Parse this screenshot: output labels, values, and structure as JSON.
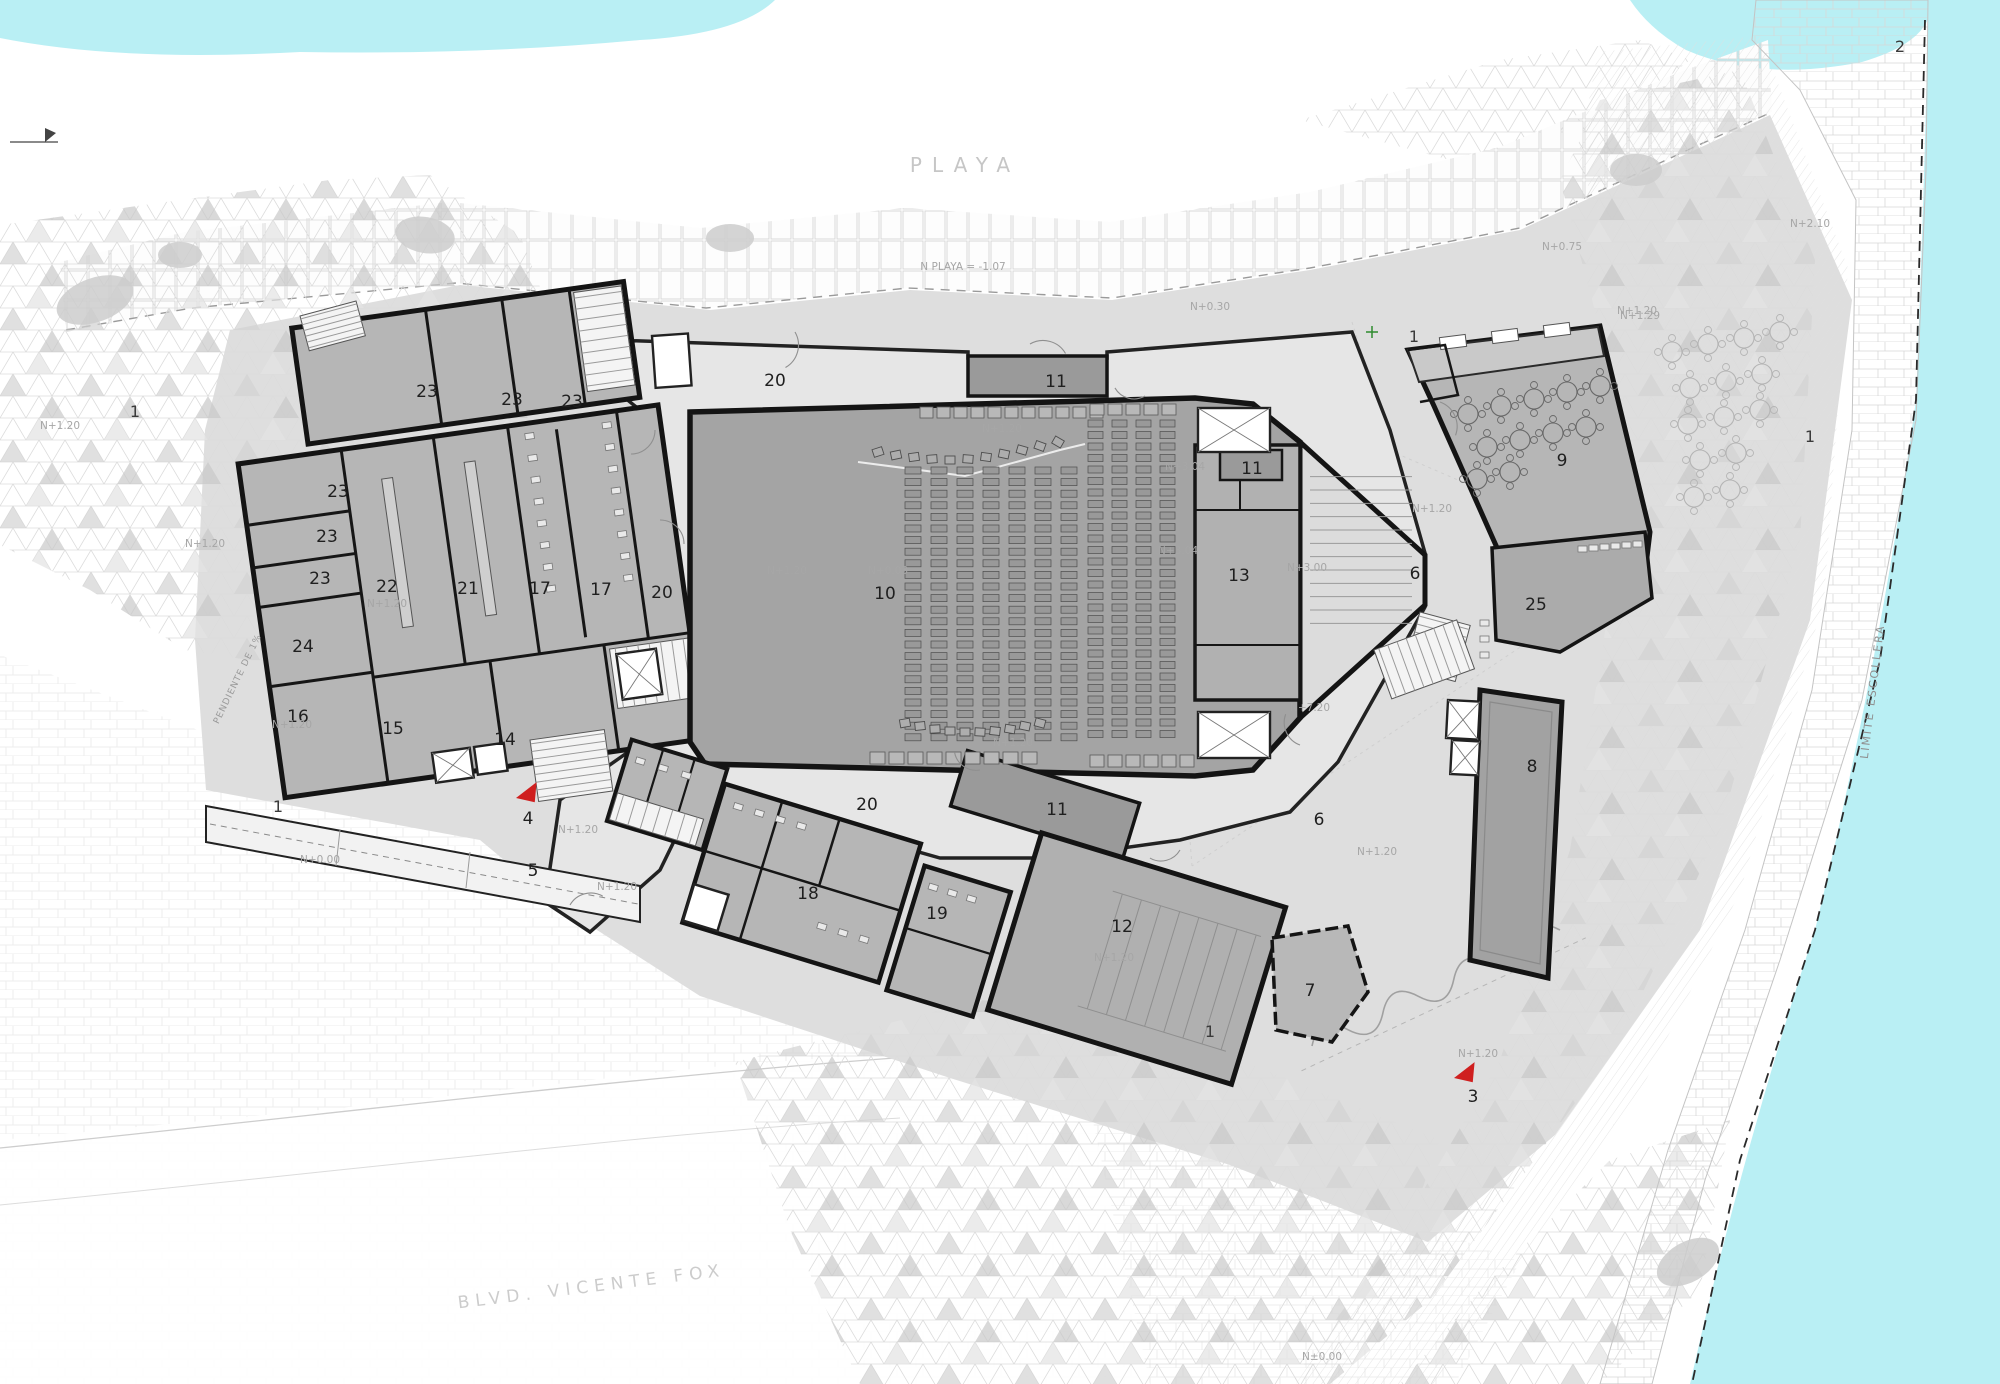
{
  "colors": {
    "water": "#b9eff4",
    "ground": "#dedede",
    "foyer": "#e6e6e6",
    "room": "#b6b6b6",
    "hall": "#a4a4a4",
    "stage": "#b1b1b1",
    "vestibule": "#9a9a9a",
    "gallery": "#a2a2a2",
    "wall": "#141414",
    "seat": "#999999",
    "seat_stroke": "#4d4d4d",
    "kitchen": "#c9c9c9",
    "red": "#cf1f1f",
    "room_label": "#1f1f1f",
    "zone_label": "#3a3a3a",
    "level_label": "#a6a6a6",
    "stair_line": "#9a9a9a",
    "table_in": "#6a6a6a",
    "table_out": "#b5b5b5",
    "green_mark": "#2e8b2e"
  },
  "street_labels": [
    {
      "t": "PLAYA",
      "x": 965,
      "y": 172,
      "size": 20,
      "ls": 10,
      "color": "#c6c6c6",
      "rot": 0
    },
    {
      "t": "BLVD. VICENTE FOX",
      "x": 592,
      "y": 1292,
      "size": 17,
      "ls": 6,
      "color": "#cccccc",
      "rot": -7
    },
    {
      "t": "LÍMITE ESCOLLERA",
      "x": 1876,
      "y": 692,
      "size": 11,
      "ls": 2,
      "color": "#8f8f8f",
      "rot": -83
    },
    {
      "t": "PENDIENTE DE 1%",
      "x": 240,
      "y": 680,
      "size": 9,
      "ls": 1,
      "color": "#9a9a9a",
      "rot": -64
    }
  ],
  "room_labels": [
    {
      "t": "23",
      "x": 427,
      "y": 397
    },
    {
      "t": "23",
      "x": 512,
      "y": 405
    },
    {
      "t": "23",
      "x": 572,
      "y": 407
    },
    {
      "t": "23",
      "x": 338,
      "y": 497
    },
    {
      "t": "23",
      "x": 327,
      "y": 542
    },
    {
      "t": "23",
      "x": 320,
      "y": 584
    },
    {
      "t": "24",
      "x": 303,
      "y": 652
    },
    {
      "t": "22",
      "x": 387,
      "y": 592
    },
    {
      "t": "21",
      "x": 468,
      "y": 594
    },
    {
      "t": "17",
      "x": 540,
      "y": 594
    },
    {
      "t": "17",
      "x": 601,
      "y": 595
    },
    {
      "t": "16",
      "x": 298,
      "y": 722
    },
    {
      "t": "15",
      "x": 393,
      "y": 734
    },
    {
      "t": "14",
      "x": 505,
      "y": 745
    },
    {
      "t": "20",
      "x": 775,
      "y": 386
    },
    {
      "t": "20",
      "x": 662,
      "y": 598
    },
    {
      "t": "20",
      "x": 867,
      "y": 810
    },
    {
      "t": "10",
      "x": 885,
      "y": 599
    },
    {
      "t": "11",
      "x": 1056,
      "y": 387
    },
    {
      "t": "11",
      "x": 1252,
      "y": 474
    },
    {
      "t": "11",
      "x": 1057,
      "y": 815
    },
    {
      "t": "13",
      "x": 1239,
      "y": 581
    },
    {
      "t": "12",
      "x": 1122,
      "y": 932
    },
    {
      "t": "18",
      "x": 808,
      "y": 899
    },
    {
      "t": "19",
      "x": 937,
      "y": 919
    },
    {
      "t": "9",
      "x": 1562,
      "y": 466
    },
    {
      "t": "25",
      "x": 1536,
      "y": 610
    },
    {
      "t": "8",
      "x": 1532,
      "y": 772
    },
    {
      "t": "6",
      "x": 1415,
      "y": 579
    },
    {
      "t": "6",
      "x": 1319,
      "y": 825
    },
    {
      "t": "7",
      "x": 1310,
      "y": 996
    },
    {
      "t": "5",
      "x": 533,
      "y": 876
    },
    {
      "t": "4",
      "x": 528,
      "y": 824
    },
    {
      "t": "3",
      "x": 1473,
      "y": 1102
    }
  ],
  "zone_labels": [
    {
      "t": "1",
      "x": 135,
      "y": 417
    },
    {
      "t": "1",
      "x": 278,
      "y": 812
    },
    {
      "t": "1",
      "x": 1414,
      "y": 342
    },
    {
      "t": "1",
      "x": 1210,
      "y": 1037
    },
    {
      "t": "1",
      "x": 1810,
      "y": 442
    },
    {
      "t": "2",
      "x": 1900,
      "y": 52
    }
  ],
  "level_labels": [
    {
      "t": "N PLAYA = -1.07",
      "x": 963,
      "y": 270
    },
    {
      "t": "N+0.30",
      "x": 1210,
      "y": 310
    },
    {
      "t": "N+0.75",
      "x": 1562,
      "y": 250
    },
    {
      "t": "N+1.29",
      "x": 1640,
      "y": 319
    },
    {
      "t": "N+2.10",
      "x": 1810,
      "y": 227
    },
    {
      "t": "N+1.20",
      "x": 60,
      "y": 429
    },
    {
      "t": "N+1.20",
      "x": 205,
      "y": 547
    },
    {
      "t": "N+1.20",
      "x": 387,
      "y": 607
    },
    {
      "t": "N+1.20",
      "x": 292,
      "y": 728
    },
    {
      "t": "N+1.20",
      "x": 787,
      "y": 574
    },
    {
      "t": "N+0.03",
      "x": 888,
      "y": 574
    },
    {
      "t": "N+1.20",
      "x": 1002,
      "y": 432
    },
    {
      "t": "N+3.04",
      "x": 1185,
      "y": 470
    },
    {
      "t": "N+3.04",
      "x": 1178,
      "y": 554
    },
    {
      "t": "N+3.00",
      "x": 1307,
      "y": 571
    },
    {
      "t": "N+1.20",
      "x": 1432,
      "y": 512
    },
    {
      "t": "N+1.20",
      "x": 1637,
      "y": 314
    },
    {
      "t": "N+1.20",
      "x": 1013,
      "y": 746
    },
    {
      "t": "N+1.20",
      "x": 1377,
      "y": 855
    },
    {
      "t": "N+1.20",
      "x": 1114,
      "y": 961
    },
    {
      "t": "N+1.20",
      "x": 1478,
      "y": 1057
    },
    {
      "t": "N+1.20",
      "x": 578,
      "y": 833
    },
    {
      "t": "N+1.20",
      "x": 617,
      "y": 890
    },
    {
      "t": "N+0.00",
      "x": 320,
      "y": 863
    },
    {
      "t": "N+7.20",
      "x": 1310,
      "y": 711
    },
    {
      "t": "N±0.00",
      "x": 1322,
      "y": 1360
    }
  ],
  "arrows": [
    {
      "x": 528,
      "y": 798,
      "rot": -15
    },
    {
      "x": 1466,
      "y": 1078,
      "rot": -15
    }
  ],
  "seat_banks": [
    {
      "x": 905,
      "y": 467,
      "cols": 7,
      "rows": 24,
      "px": 26,
      "py": 11.6,
      "w": 16,
      "h": 7
    },
    {
      "x": 1088,
      "y": 420,
      "cols": 4,
      "rows": 28,
      "px": 24,
      "py": 11.5,
      "w": 15,
      "h": 7
    }
  ],
  "seat_strips": [
    {
      "x": 920,
      "y": 407,
      "n": 11,
      "pitch": 17,
      "w": 13,
      "h": 11
    },
    {
      "x": 1090,
      "y": 404,
      "n": 5,
      "pitch": 18,
      "w": 14,
      "h": 11
    },
    {
      "x": 870,
      "y": 752,
      "n": 9,
      "pitch": 19,
      "w": 15,
      "h": 12
    },
    {
      "x": 1090,
      "y": 755,
      "n": 6,
      "pitch": 18,
      "w": 14,
      "h": 12
    }
  ],
  "loose_chairs": [
    [
      878,
      452,
      -18
    ],
    [
      896,
      455,
      -12
    ],
    [
      914,
      457,
      -8
    ],
    [
      932,
      459,
      -4
    ],
    [
      950,
      460,
      0
    ],
    [
      968,
      459,
      4
    ],
    [
      986,
      457,
      8
    ],
    [
      1004,
      454,
      12
    ],
    [
      1022,
      450,
      16
    ],
    [
      1040,
      446,
      20
    ],
    [
      1058,
      442,
      30
    ],
    [
      905,
      723,
      -10
    ],
    [
      920,
      726,
      -6
    ],
    [
      935,
      729,
      -3
    ],
    [
      950,
      731,
      0
    ],
    [
      965,
      732,
      0
    ],
    [
      980,
      732,
      3
    ],
    [
      995,
      731,
      6
    ],
    [
      1010,
      729,
      9
    ],
    [
      1025,
      726,
      12
    ],
    [
      1040,
      723,
      15
    ]
  ],
  "tables": {
    "r": 10,
    "inner": [
      [
        1468,
        414
      ],
      [
        1501,
        406
      ],
      [
        1534,
        399
      ],
      [
        1567,
        392
      ],
      [
        1600,
        386
      ],
      [
        1487,
        447
      ],
      [
        1520,
        440
      ],
      [
        1553,
        433
      ],
      [
        1586,
        427
      ],
      [
        1477,
        479
      ],
      [
        1510,
        472
      ]
    ],
    "outer": [
      [
        1672,
        352
      ],
      [
        1708,
        344
      ],
      [
        1744,
        338
      ],
      [
        1780,
        332
      ],
      [
        1690,
        388
      ],
      [
        1726,
        381
      ],
      [
        1762,
        374
      ],
      [
        1688,
        424
      ],
      [
        1724,
        417
      ],
      [
        1760,
        410
      ],
      [
        1700,
        460
      ],
      [
        1736,
        453
      ],
      [
        1694,
        497
      ],
      [
        1730,
        490
      ]
    ]
  },
  "stairs": [
    {
      "x": 1310,
      "y": 470,
      "w": 102,
      "h": 160,
      "n": 12,
      "dir": "h",
      "rot": 0,
      "bg": 0
    },
    {
      "x": 530,
      "y": 740,
      "w": 75,
      "h": 62,
      "n": 8,
      "dir": "h",
      "rot": -8,
      "bg": 1
    },
    {
      "x": 1420,
      "y": 612,
      "w": 52,
      "h": 58,
      "n": 7,
      "dir": "h",
      "rot": 15,
      "bg": 1
    },
    {
      "x": 1374,
      "y": 650,
      "w": 88,
      "h": 52,
      "n": 9,
      "dir": "v",
      "rot": -20,
      "bg": 1
    },
    {
      "x": 300,
      "y": 316,
      "w": 58,
      "h": 36,
      "n": 6,
      "dir": "h",
      "rot": -15,
      "bg": 1
    },
    {
      "g": "L",
      "x": 604,
      "y": 312,
      "w": 48,
      "h": 100,
      "n": 9,
      "dir": "h",
      "rot": 0,
      "bg": 1
    },
    {
      "g": "L",
      "x": 590,
      "y": 670,
      "w": 80,
      "h": 60,
      "n": 7,
      "dir": "v",
      "rot": 0,
      "bg": 1
    },
    {
      "g": "S",
      "x": 600,
      "y": 850,
      "w": 90,
      "h": 28,
      "n": 7,
      "dir": "v",
      "rot": 0,
      "bg": 1
    }
  ],
  "boxes": [
    {
      "x": 1198,
      "y": 408,
      "w": 72,
      "h": 44,
      "rot": 0,
      "noX": 0
    },
    {
      "x": 1198,
      "y": 712,
      "w": 72,
      "h": 46,
      "rot": 0,
      "noX": 0
    },
    {
      "x": 432,
      "y": 753,
      "w": 38,
      "h": 30,
      "rot": -8,
      "noX": 0
    },
    {
      "x": 474,
      "y": 747,
      "w": 30,
      "h": 28,
      "rot": -8,
      "noX": 1
    },
    {
      "x": 1448,
      "y": 700,
      "w": 32,
      "h": 38,
      "rot": 3,
      "noX": 0
    },
    {
      "x": 1452,
      "y": 740,
      "w": 28,
      "h": 34,
      "rot": 3,
      "noX": 0
    },
    {
      "g": "L",
      "x": 596,
      "y": 676,
      "w": 40,
      "h": 46,
      "rot": 0,
      "noX": 0
    },
    {
      "x": 652,
      "y": 336,
      "w": 36,
      "h": 52,
      "rot": -4,
      "noX": 1
    }
  ],
  "fixtures": [
    {
      "x": 1578,
      "y": 546,
      "dx": 11,
      "dy": -1,
      "n": 6
    },
    {
      "x": 1480,
      "y": 620,
      "dx": 0,
      "dy": 16,
      "n": 3
    },
    {
      "g": "L",
      "x": 536,
      "y": 445,
      "dx": 0,
      "dy": 22,
      "n": 8
    },
    {
      "g": "L",
      "x": 614,
      "y": 445,
      "dx": 0,
      "dy": 22,
      "n": 8
    },
    {
      "g": "S",
      "x": 608,
      "y": 810,
      "dx": 24,
      "dy": 0,
      "n": 3
    },
    {
      "g": "S",
      "x": 715,
      "y": 825,
      "dx": 22,
      "dy": 0,
      "n": 4
    },
    {
      "g": "S",
      "x": 830,
      "y": 915,
      "dx": 22,
      "dy": 0,
      "n": 3
    },
    {
      "g": "S",
      "x": 925,
      "y": 845,
      "dx": 20,
      "dy": 0,
      "n": 3
    }
  ],
  "waves": {
    "x1": 1312,
    "y1": 1046,
    "x2": 1560,
    "y2": 930,
    "n": 7,
    "amp": 26
  },
  "construction_lines": [
    [
      1152,
      348,
      1648,
      562
    ],
    [
      1648,
      562,
      1192,
      866
    ],
    [
      1192,
      866,
      1152,
      348
    ],
    [
      1352,
      322,
      1425,
      555
    ]
  ],
  "door_arcs": [
    [
      795,
      332,
      26,
      60
    ],
    [
      1030,
      344,
      26,
      -30
    ],
    [
      1145,
      396,
      22,
      150
    ],
    [
      660,
      520,
      24,
      0
    ],
    [
      655,
      430,
      24,
      90
    ],
    [
      1440,
      402,
      26,
      20
    ],
    [
      1300,
      745,
      24,
      200
    ],
    [
      980,
      770,
      22,
      170
    ],
    [
      570,
      905,
      24,
      -60
    ],
    [
      1180,
      850,
      22,
      120
    ]
  ],
  "blobs": [
    [
      95,
      300,
      40,
      22,
      -20
    ],
    [
      425,
      235,
      30,
      18,
      10
    ],
    [
      1636,
      170,
      26,
      16,
      0
    ],
    [
      730,
      238,
      24,
      14,
      0
    ],
    [
      1688,
      1262,
      34,
      20,
      -30
    ],
    [
      180,
      255,
      22,
      13,
      0
    ]
  ]
}
